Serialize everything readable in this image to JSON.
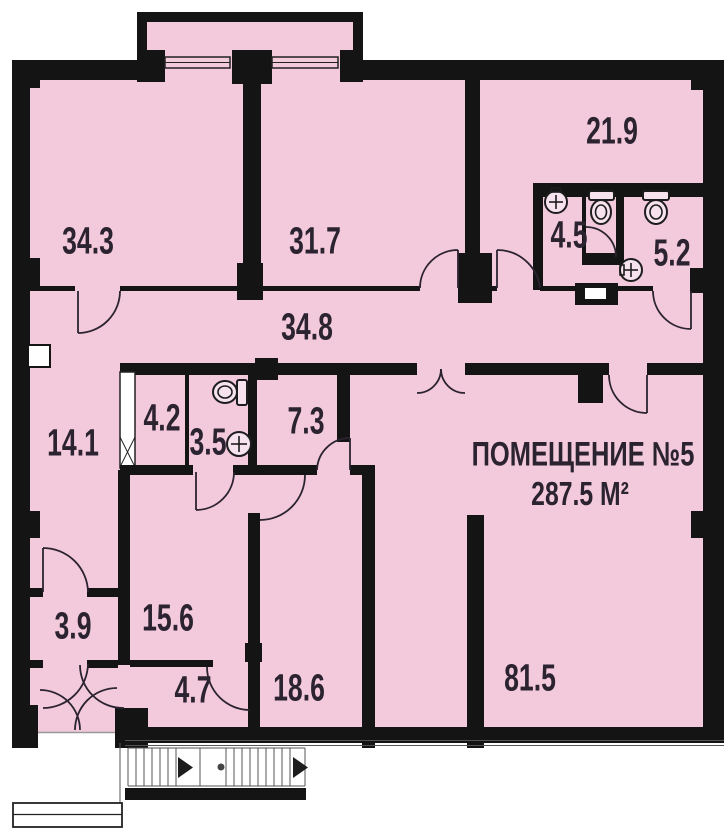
{
  "plan": {
    "unit": {
      "title": "ПОМЕЩЕНИЕ №5",
      "total_area": "287.5 М²"
    },
    "rooms": [
      {
        "area": "34.3"
      },
      {
        "area": "31.7"
      },
      {
        "area": "21.9"
      },
      {
        "area": "4.5"
      },
      {
        "area": "5.2"
      },
      {
        "area": "34.8"
      },
      {
        "area": "14.1"
      },
      {
        "area": "4.2"
      },
      {
        "area": "3.5"
      },
      {
        "area": "7.3"
      },
      {
        "area": "3.9"
      },
      {
        "area": "15.6"
      },
      {
        "area": "4.7"
      },
      {
        "area": "18.6"
      },
      {
        "area": "81.5"
      }
    ],
    "colors": {
      "floor": "#F3C9DC",
      "wall": "#141414",
      "line": "#2B2330"
    },
    "icons": {
      "sink-icon": "circle-with-cross-tap",
      "toilet-icon": "tank-and-bowl",
      "stairs-arrow-icon": "right-pointing-triangle",
      "shaft-icon": "rect-with-diagonal-cross"
    }
  }
}
